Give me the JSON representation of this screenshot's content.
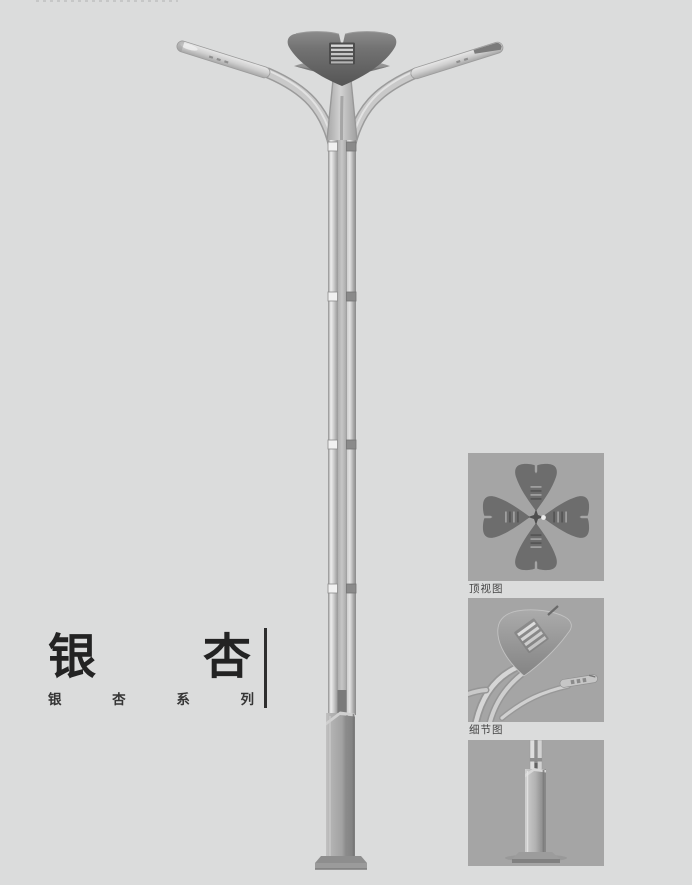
{
  "page": {
    "width": 692,
    "height": 885,
    "background": "#dbdcdc"
  },
  "product": {
    "title": "银杏",
    "series": "银杏系列"
  },
  "gallery": {
    "panels": [
      {
        "id": "top-view",
        "label": "顶视图"
      },
      {
        "id": "detail-view",
        "label": "细节图"
      },
      {
        "id": "base-view"
      }
    ]
  },
  "illustration": {
    "subject": "ginkgo-double-arm-street-lamp",
    "colors": {
      "page_bg": "#dbdcdc",
      "panel_bg": "#a5a5a5",
      "metal_light": "#d6d6d6",
      "metal_mid": "#a8a8a8",
      "crown_dark": "#636363",
      "text_dark": "#232323"
    }
  }
}
